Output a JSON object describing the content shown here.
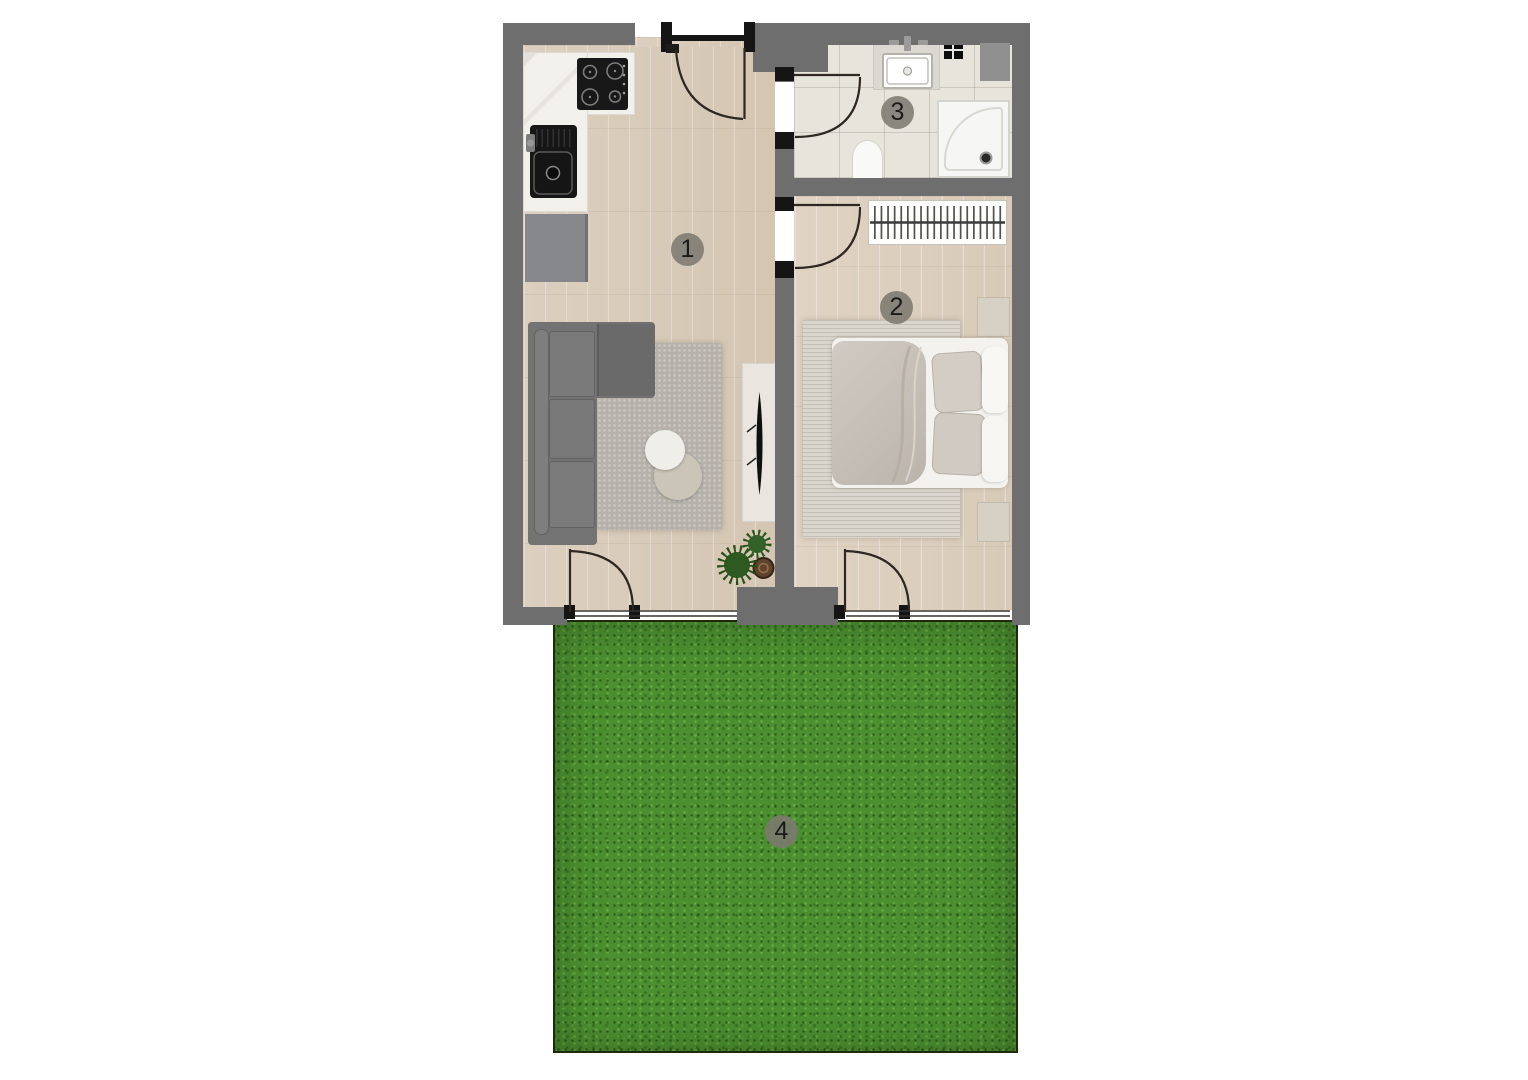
{
  "floorplan": {
    "name": "apartment-floor-plan-with-garden",
    "rooms": [
      {
        "number": "1",
        "name": "living-room-with-kitchen"
      },
      {
        "number": "2",
        "name": "bedroom"
      },
      {
        "number": "3",
        "name": "bathroom"
      },
      {
        "number": "4",
        "name": "garden"
      }
    ],
    "colors": {
      "wall": "#6f6e6e",
      "duct": "#909090",
      "wood_floor": "#d9ccba",
      "bath_tile": "#e7e4dc",
      "grass": "#4c8f31",
      "label_circle": "#7d7a71",
      "label_text": "#1b1b1b",
      "door_line": "#2e2722"
    }
  }
}
